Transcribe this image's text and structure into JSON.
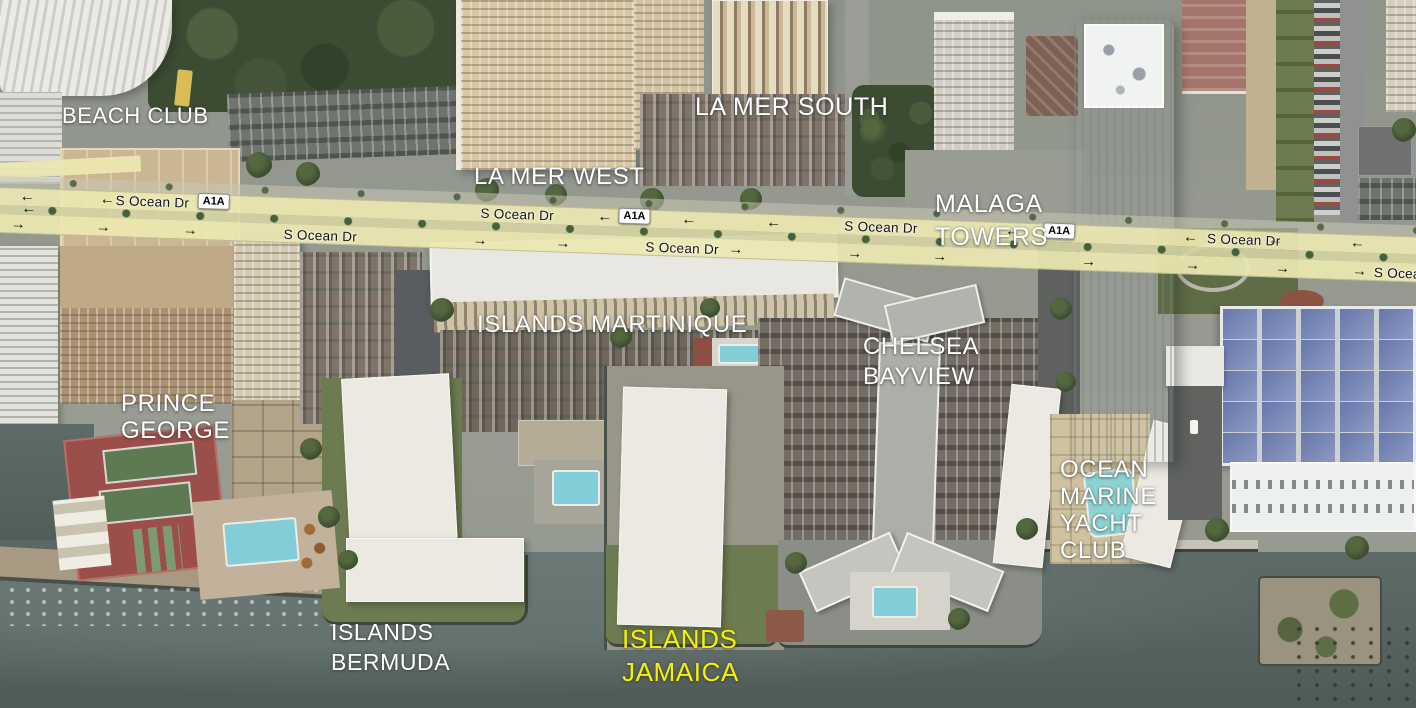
{
  "building_labels": [
    {
      "name": "label-beach-club",
      "text": "BEACH CLUB",
      "x": 62,
      "y": 103,
      "size": 22,
      "lh": 26,
      "color": "#ffffff"
    },
    {
      "name": "label-la-mer-south",
      "text": "LA MER SOUTH",
      "x": 695,
      "y": 93,
      "size": 25,
      "lh": 28,
      "color": "#ffffff"
    },
    {
      "name": "label-la-mer-west",
      "text": "LA MER WEST",
      "x": 474,
      "y": 163,
      "size": 24,
      "lh": 28,
      "color": "#ffffff"
    },
    {
      "name": "label-malaga-towers",
      "text": "MALAGA\nTOWERS",
      "x": 935,
      "y": 188,
      "size": 25,
      "lh": 33,
      "color": "#ffffff"
    },
    {
      "name": "label-islands-martinique",
      "text": "ISLANDS MARTINIQUE",
      "x": 477,
      "y": 311,
      "size": 24,
      "lh": 28,
      "color": "#ffffff"
    },
    {
      "name": "label-chelsea-bayview",
      "text": "CHELSEA\nBAYVIEW",
      "x": 863,
      "y": 332,
      "size": 24,
      "lh": 30,
      "color": "#ffffff"
    },
    {
      "name": "label-prince-george",
      "text": "PRINCE\nGEORGE",
      "x": 121,
      "y": 390,
      "size": 24,
      "lh": 27,
      "color": "#ffffff"
    },
    {
      "name": "label-ocean-marine-yacht-club",
      "text": "OCEAN\nMARINE\nYACHT\nCLUB",
      "x": 1060,
      "y": 456,
      "size": 24,
      "lh": 27,
      "color": "#ffffff"
    },
    {
      "name": "label-islands-bermuda",
      "text": "ISLANDS\nBERMUDA",
      "x": 331,
      "y": 617,
      "size": 23,
      "lh": 30,
      "color": "#ffffff"
    },
    {
      "name": "label-islands-jamaica",
      "text": "ISLANDS\nJAMAICA",
      "x": 622,
      "y": 623,
      "size": 26,
      "lh": 33,
      "color": "#f5f200"
    }
  ],
  "road": {
    "name": "S Ocean Dr",
    "route": "A1A",
    "name_labels": [
      {
        "text": "S Ocean Dr",
        "x": 116,
        "y": 189
      },
      {
        "text": "S Ocean Dr",
        "x": 481,
        "y": 189
      },
      {
        "text": "S Ocean Dr",
        "x": 845,
        "y": 189
      },
      {
        "text": "S Ocean Dr",
        "x": 1208,
        "y": 189
      },
      {
        "text": "S Ocean Dr",
        "x": 285,
        "y": 217
      },
      {
        "text": "S Ocean Dr",
        "x": 647,
        "y": 217
      },
      {
        "text": "S Ocean Dr",
        "x": 1376,
        "y": 217
      }
    ],
    "shields": [
      {
        "text": "A1A",
        "x": 198,
        "y": 186
      },
      {
        "text": "A1A",
        "x": 619,
        "y": 186
      },
      {
        "text": "A1A",
        "x": 1044,
        "y": 186
      }
    ],
    "arrows": [
      {
        "glyph": "←",
        "x": 20,
        "y": 189
      },
      {
        "glyph": "←",
        "x": 22,
        "y": 201
      },
      {
        "glyph": "←",
        "x": 100,
        "y": 189
      },
      {
        "glyph": "←",
        "x": 598,
        "y": 189
      },
      {
        "glyph": "←",
        "x": 682,
        "y": 189
      },
      {
        "glyph": "←",
        "x": 767,
        "y": 189
      },
      {
        "glyph": "←",
        "x": 1006,
        "y": 189
      },
      {
        "glyph": "←",
        "x": 1184,
        "y": 189
      },
      {
        "glyph": "←",
        "x": 1269,
        "y": 189
      },
      {
        "glyph": "←",
        "x": 1351,
        "y": 189
      },
      {
        "glyph": "→",
        "x": 12,
        "y": 217
      },
      {
        "glyph": "→",
        "x": 97,
        "y": 217
      },
      {
        "glyph": "→",
        "x": 184,
        "y": 217
      },
      {
        "glyph": "→",
        "x": 474,
        "y": 217
      },
      {
        "glyph": "→",
        "x": 557,
        "y": 217
      },
      {
        "glyph": "→",
        "x": 730,
        "y": 217
      },
      {
        "glyph": "→",
        "x": 849,
        "y": 217
      },
      {
        "glyph": "→",
        "x": 934,
        "y": 217
      },
      {
        "glyph": "→",
        "x": 1083,
        "y": 217
      },
      {
        "glyph": "→",
        "x": 1187,
        "y": 217
      },
      {
        "glyph": "→",
        "x": 1277,
        "y": 217
      },
      {
        "glyph": "→",
        "x": 1354,
        "y": 217
      }
    ]
  },
  "colors": {
    "water": "#5c6a66",
    "road_highlight": "#ece7b2",
    "median": "#d3d2a2",
    "label_primary": "#ffffff",
    "label_highlight": "#f5f200",
    "arrow": "#101010",
    "shield_bg": "#ffffff",
    "shield_text": "#000000"
  }
}
